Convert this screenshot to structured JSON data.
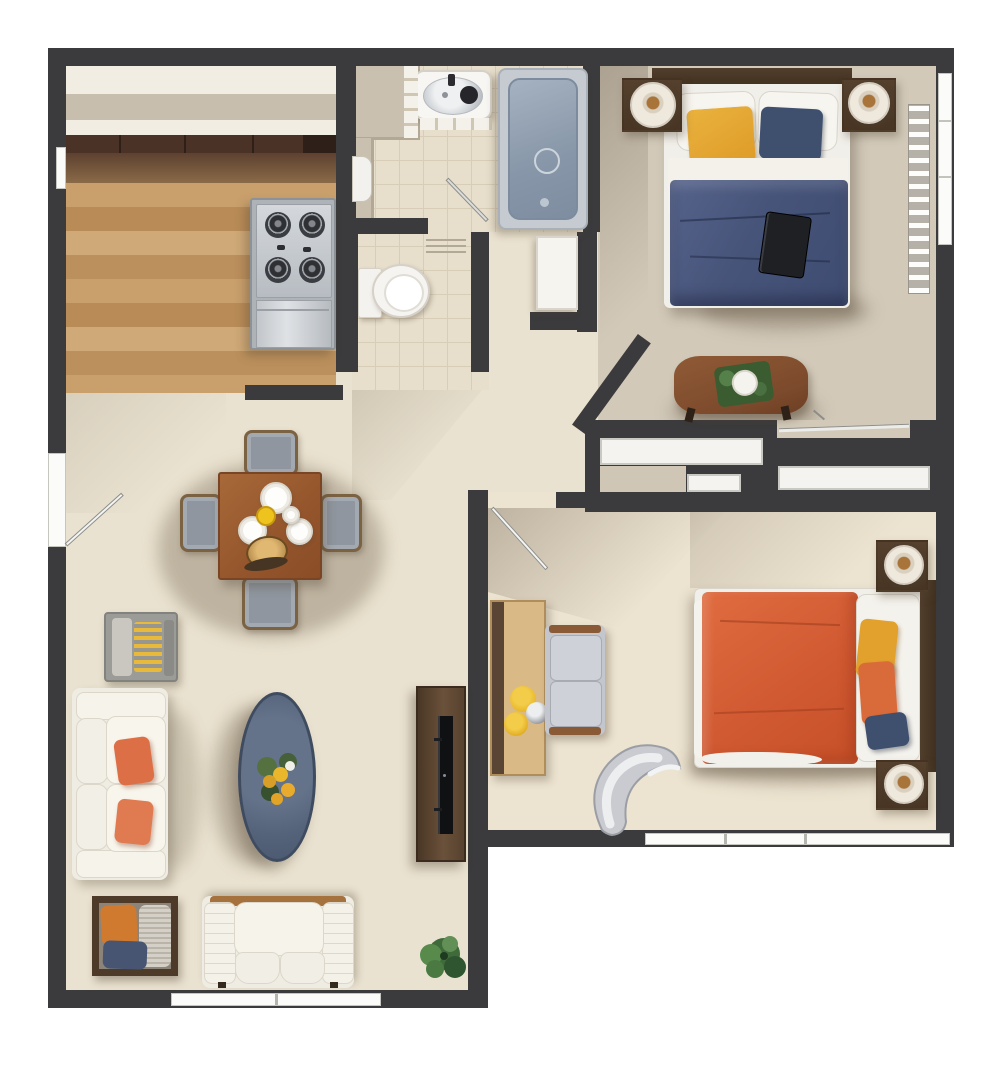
{
  "page": {
    "title": "Two-bedroom apartment floor plan (top-down 3D render)",
    "background": "#ffffff"
  },
  "colors": {
    "wall": "#3b3a3c",
    "floor": "#eae2d0",
    "bed1Floor": "#d2c9b9",
    "bed2Floor": "#ece3d0",
    "tile": "#e7decb",
    "tileLine": "#d8cdb6",
    "counter": "#c9c0b0",
    "cabinet": "#4a3227",
    "steel": "#c9cdd1",
    "steelDark": "#8d9298",
    "tubOuter": "#c6cbd1",
    "tubInner": "#90a0b0",
    "navyBlanket": "#47547a",
    "pillowYellow": "#e2a02c",
    "pillowNavy": "#3f4f6e",
    "orangeBlanket": "#d65f35",
    "pillowOrange": "#d96b3a",
    "sofaWhite": "#efece3",
    "pillowCoral": "#dd6f47",
    "ovalTable": "#55637a",
    "consoleWood": "#553f2c",
    "benchWood": "#8a5434",
    "diningWood": "#9a5c30",
    "chairGray": "#8f969f",
    "closetWhite": "#f4f3f0",
    "lampWhite": "#efe9dd",
    "lampAmber": "#a8743a",
    "plantGreen": "#4a7a42",
    "deskTan": "#d9b986",
    "trimBrown": "#5a4434",
    "accentOrange": "#cf7a2e",
    "accentNavy": "#475572"
  },
  "rooms": {
    "plan": {
      "label": "Top-down floor plan of a two-bedroom apartment"
    },
    "kitchen": {
      "label": "Kitchen with wood floor, upper cabinets, counter and 4-burner gas cooktop"
    },
    "bathroom": {
      "label": "Bathroom with vanity sink, bathtub and laundry basket"
    },
    "wc": {
      "label": "Toilet room with toilet and storage cabinet"
    },
    "bedroom1": {
      "label": "Bedroom 1 with navy double bed, two nightstands with lamps, bench table, radiator, window and sliding closet"
    },
    "hallway": {
      "label": "Hallway connecting kitchen, bathroom and bedrooms"
    },
    "living": {
      "label": "Living and dining room with dining set, sofa, oval coffee table, TV console, accent chair, loveseat and plant"
    },
    "bedroom2": {
      "label": "Bedroom 2 with orange double bed, two nightstands with lamps, desk, settee and lounge chair"
    }
  },
  "furniture": {
    "cooktop": "gas cooktop with four burners",
    "sink": "vanity sink with dark faucet",
    "bathtub": "bathtub with drain",
    "toilet": "toilet",
    "bed1": "double bed with navy duvet, yellow and navy pillows, tablet on bed",
    "bench1": "wooden bench table with plant tray",
    "closet": "sliding-door closets",
    "diningTable": "square wooden dining table with plates, yellow cup and bread basket",
    "diningChairs": "four gray dining chairs",
    "sofa": "white three-seat sofa with two coral pillows",
    "armchair": "gray armchair with yellow striped cushion",
    "ovalTable": "oval slate coffee table with flower bouquet",
    "tvConsole": "dark wood TV console with flat TV",
    "accentChair": "wood-frame accent chair with orange, gray and navy pillows",
    "loveseat": "white quilted loveseat",
    "plant": "potted green plant",
    "bed2": "double bed with orange duvet, yellow, orange and navy pillows",
    "desk": "wall desk with yellow bowls",
    "settee": "gray two-seat settee with wood trim",
    "loungeChair": "curved gray lounge chair"
  }
}
